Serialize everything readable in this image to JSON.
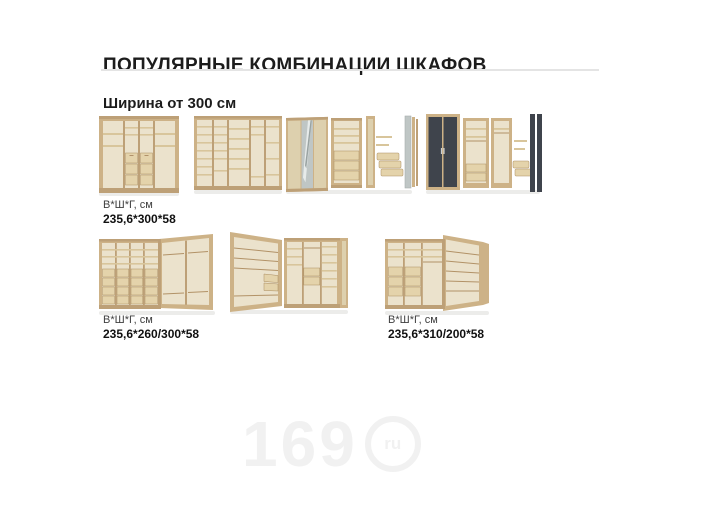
{
  "header": {
    "title": "ПОПУЛЯРНЫЕ КОМБИНАЦИИ ШКАФОВ",
    "subtitle": "Ширина от 300 см"
  },
  "combos": {
    "row1": {
      "dims_caption": "В*Ш*Г, см",
      "dims_value": "235,6*300*58"
    },
    "row2_left": {
      "dims_caption": "В*Ш*Г, см",
      "dims_value": "235,6*260/300*58"
    },
    "row2_right": {
      "dims_caption": "В*Ш*Г, см",
      "dims_value": "235,6*310/200*58"
    }
  },
  "watermark": {
    "number": "169",
    "domain": "ru"
  },
  "colors": {
    "wood_frame": "#cdb287",
    "wood_interior": "#ebe2cc",
    "dark_door": "#3f444c",
    "mirror": "#bfc6c5",
    "title_text": "#1c1c1c",
    "divider": "#e4e4e4",
    "watermark": "#f1f1f1"
  }
}
